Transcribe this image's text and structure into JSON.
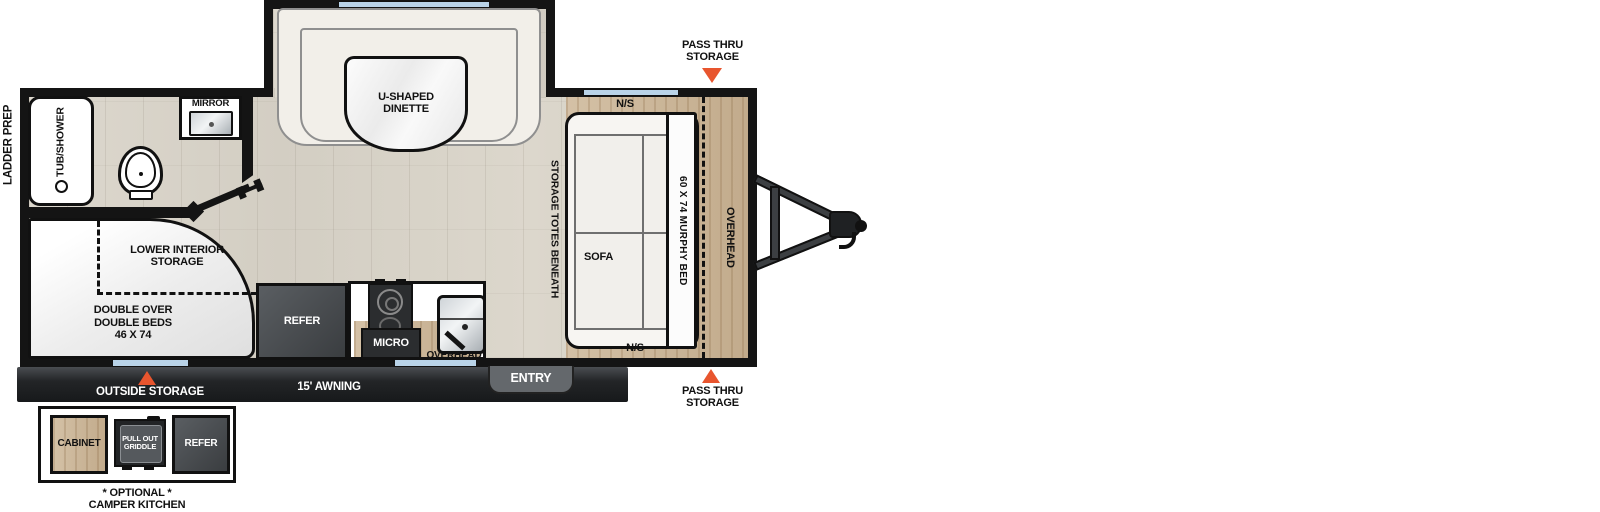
{
  "title": "Travel trailer floorplan diagram",
  "labels": {
    "ladder_prep": "LADDER PREP",
    "pass_thru_top": [
      "PASS THRU",
      "STORAGE"
    ],
    "pass_thru_bottom": [
      "PASS THRU",
      "STORAGE"
    ],
    "tub_shower": "TUB/SHOWER",
    "mirror": "MIRROR",
    "dinette": [
      "U-SHAPED",
      "DINETTE"
    ],
    "lower_interior_storage": [
      "LOWER INTERIOR",
      "STORAGE"
    ],
    "double_beds": [
      "DOUBLE OVER",
      "DOUBLE BEDS",
      "46 X 74"
    ],
    "refer": "REFER",
    "micro": "MICRO",
    "overhead_kitchen": "OVERHEAD",
    "storage_totes": "STORAGE TOTES BENEATH",
    "sofa": "SOFA",
    "murphy_bed": "60 X 74 MURPHY BED",
    "overhead_bedroom": "OVERHEAD",
    "ns_top": "N/S",
    "ns_bottom": "N/S",
    "outside_storage": "OUTSIDE STORAGE",
    "awning": "15' AWNING",
    "entry": "ENTRY",
    "camper_kitchen": {
      "cabinet": "CABINET",
      "griddle": [
        "PULL OUT",
        "GRIDDLE"
      ],
      "refer": "REFER",
      "caption": [
        "* OPTIONAL *",
        "CAMPER KITCHEN"
      ]
    }
  },
  "colors": {
    "wall": "#141414",
    "floor_wood": "#d8d3c9",
    "platform_wood": "#c9b49a",
    "window_blue": "#b9d3e8",
    "marker_orange": "#e8552e",
    "banner_dark": "#232527",
    "appliance_dark": "#2b2d2f",
    "refer_gray": "#45484c"
  }
}
